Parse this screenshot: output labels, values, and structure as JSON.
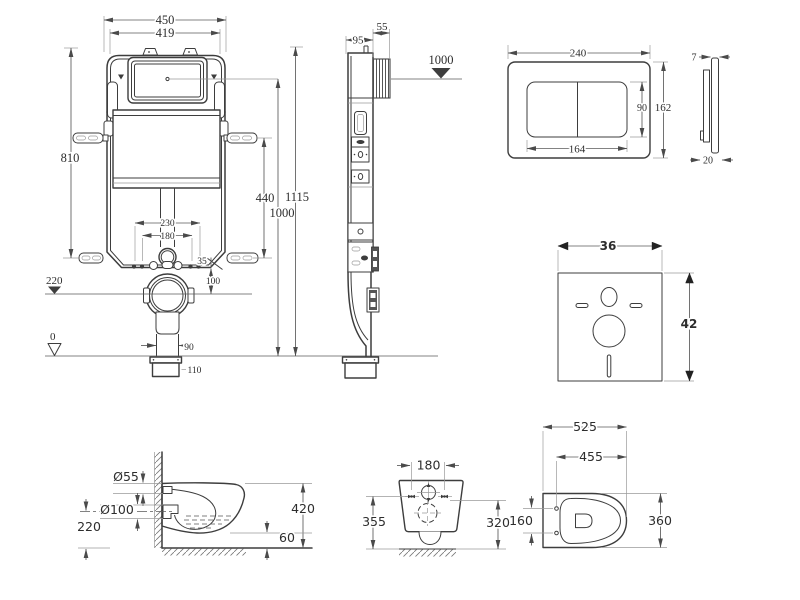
{
  "colors": {
    "ink": "#3d3d3d",
    "background": "#ffffff"
  },
  "views": {
    "frame_front": {
      "d450": "450",
      "d419": "419",
      "d810": "810",
      "d440": "440",
      "d1115": "1115",
      "d1000": "1000",
      "d230": "230",
      "d180": "180",
      "d35": "35",
      "d100": "100",
      "d90": "90",
      "d110": "110",
      "datum_220": "220",
      "datum_0": "0"
    },
    "frame_side": {
      "d95": "95",
      "d55": "55",
      "datum_1000": "1000"
    },
    "plate_front": {
      "d240": "240",
      "d162": "162",
      "d90": "90",
      "d164": "164"
    },
    "plate_side": {
      "d7": "7",
      "d20": "20"
    },
    "sound_pad": {
      "d36": "36",
      "d42": "42"
    },
    "pan_side": {
      "d55": "Ø55",
      "d100": "Ø100",
      "d220": "220",
      "d420": "420",
      "d60": "60"
    },
    "pan_rear": {
      "d180": "180",
      "d355": "355",
      "d320": "320"
    },
    "pan_top": {
      "d525": "525",
      "d455": "455",
      "d160": "160",
      "d360": "360"
    }
  }
}
